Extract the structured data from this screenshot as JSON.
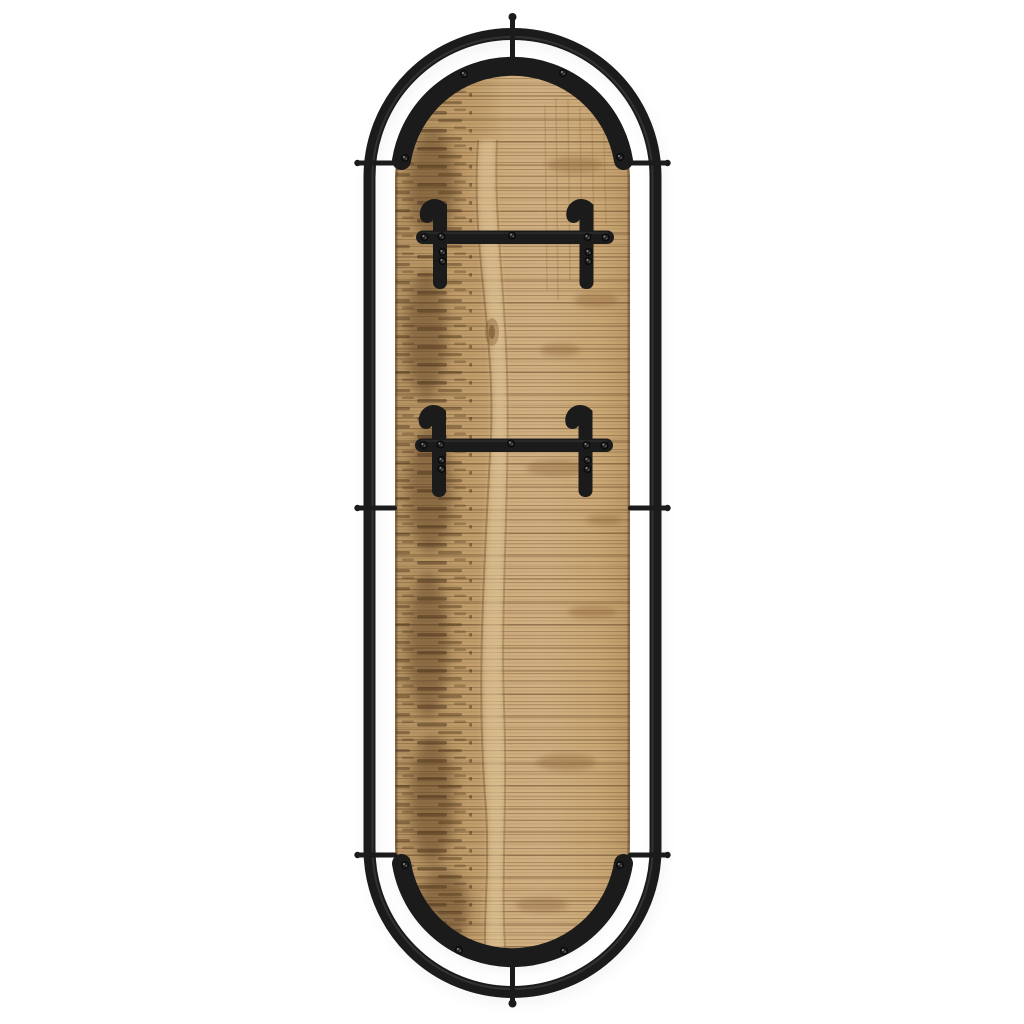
{
  "scene": {
    "type": "product-photo",
    "subject": "Oval wall-mounted coat rack: rough-sawn mango wood capsule panel inside a black metal stadium tube frame, arched black metal bands riveted to the panel top and bottom, two horizontal hook rails each with two curled strap hooks, side mounting pins and top/bottom support rods",
    "parts": [
      "outer-metal-frame",
      "wood-panel",
      "top-arc-band",
      "bottom-arc-band",
      "hook-rail-upper",
      "hook-rail-lower",
      "strap-hooks",
      "mounting-pins",
      "support-rods",
      "screws"
    ]
  },
  "colors": {
    "background": "#ffffff",
    "metal": "#1b1b1b",
    "metal_soft": "#2b2b2b",
    "metal_highlight": "#6a6a6a",
    "wood_base": "#c9a46f",
    "wood_light": "#dcc094",
    "wood_mid": "#b98f5e",
    "wood_dark": "#6b4a26",
    "wood_streak": "#4f351a",
    "screw_dark": "#0a0a0a",
    "screw_glint": "#9b9b9b"
  }
}
